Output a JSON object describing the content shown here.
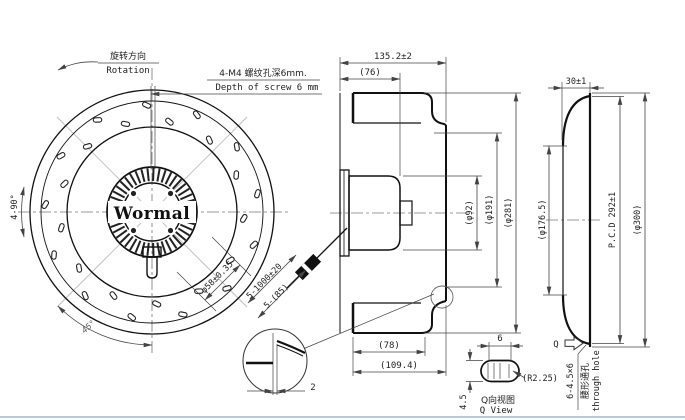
{
  "front": {
    "rotation_cn": "旋转方向",
    "rotation_en": "Rotation",
    "tap_note_cn": "4-M4 螺纹孔深6mm.",
    "tap_note_en": "Depth of screw 6 mm",
    "pattern_angle": "4-90°",
    "angle_dim": "45°",
    "hub_circle_dia": "φ58±0.35",
    "logo": "Wormal",
    "cable_dim": "5-1000±20",
    "cable_len": "5-(85)"
  },
  "section": {
    "depth_total": "135.2±2",
    "depth_motor": "(76)",
    "dia_motor": "(φ92)",
    "dia_inner": "(φ191)",
    "dia_outer": "(φ281)",
    "width_blade": "(78)",
    "width_total": "(109.4)",
    "plate_thickness": "2"
  },
  "side": {
    "flange_width": "30±1",
    "dia_inlet": "(φ176.5)",
    "pcd": "P.C.D 292±1",
    "dia_outer": "(φ300)",
    "view_label": "Q",
    "hole_spec": "6-4.5×6",
    "hole_type_cn": "腰形通孔",
    "hole_type_en": "through hole"
  },
  "qview": {
    "slot_pitch": "6",
    "slot_width": "4.5",
    "corner_radius": "(R2.25)",
    "title_cn": "Q向视图",
    "title_en": "Q View"
  },
  "colors": {
    "line": "#111111",
    "dim": "#444444",
    "frame_bottom": "#aecbe8"
  }
}
